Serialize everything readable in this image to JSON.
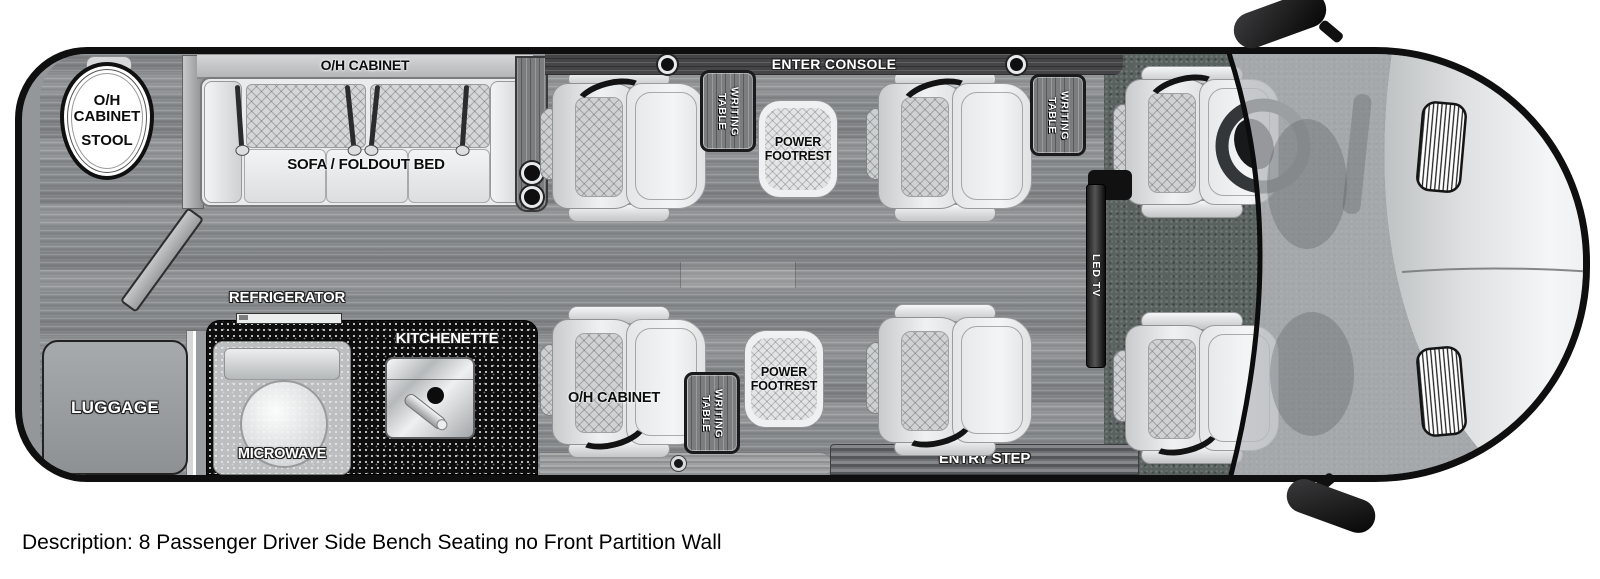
{
  "description": "Description: 8 Passenger Driver Side Bench Seating no Front Partition Wall",
  "labels": {
    "rear_overhead_cabinet": "O/H\nCABINET",
    "rear_stool": "STOOL",
    "sofa_overhead_cabinet": "O/H CABINET",
    "sofa": "SOFA / FOLDOUT BED",
    "center_console": "ENTER CONSOLE",
    "writing_table": "WRITING\nTABLE",
    "power_footrest": "POWER\nFOOTREST",
    "refrigerator": "REFRIGERATOR",
    "kitchenette": "KITCHENETTE",
    "microwave": "MICROWAVE",
    "luggage": "LUGGAGE",
    "lower_overhead_cabinet": "O/H CABINET",
    "led_tv": "LED TV",
    "entry_step": "ENTRY STEP"
  },
  "colors": {
    "outline": "#0f0f0f",
    "floor_wood": "#8d9093",
    "cab_carpet": "#5a625f",
    "counter_black": "#0e0e0e",
    "upholstery": "#e9ebec",
    "wall_gray": "#94979a",
    "label_white": "#ffffff",
    "label_black": "#0c0c0c"
  }
}
